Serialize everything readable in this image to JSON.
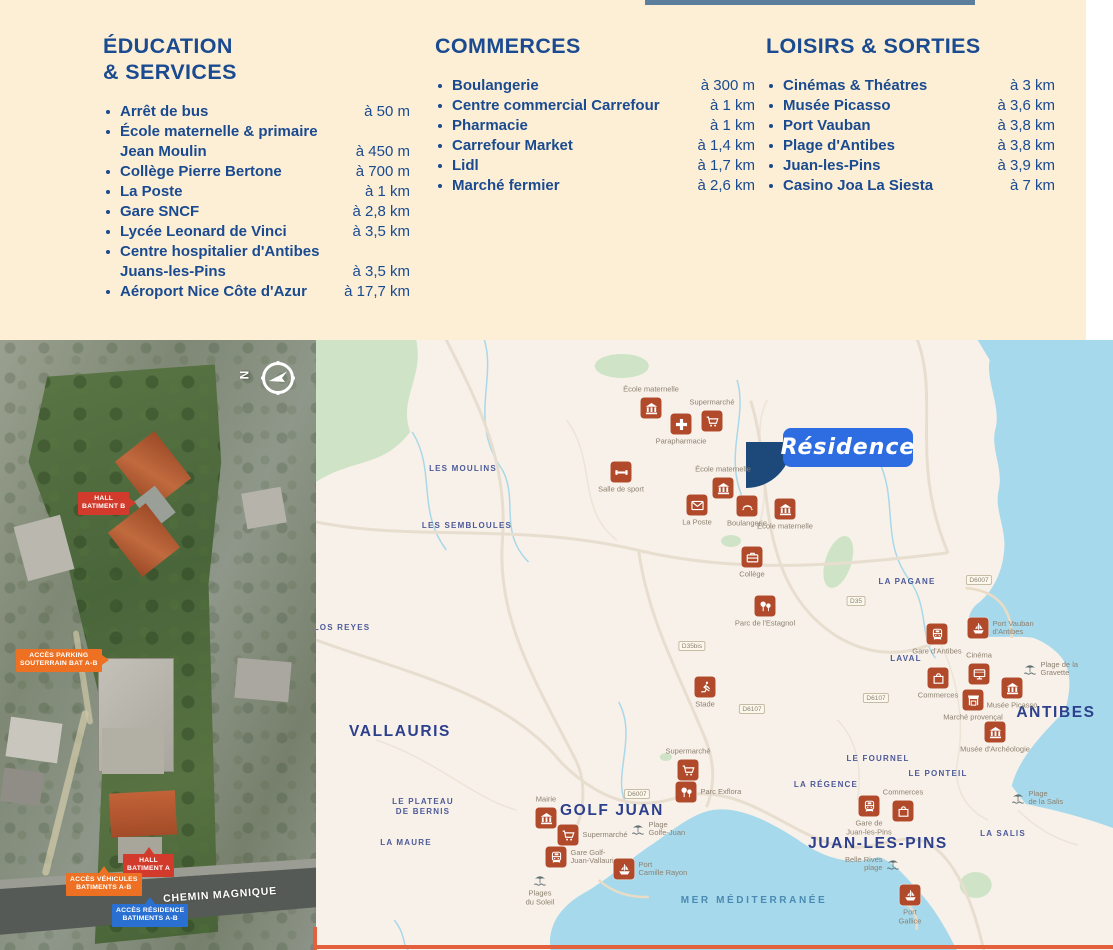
{
  "colors": {
    "navy": "#1a4a90",
    "cream": "#fcefd6",
    "rust": "#b04a2a",
    "map_bg": "#f8f1e9",
    "water": "#a6d9ec",
    "green": "#cfe4c6",
    "orange": "#ee7123",
    "red": "#d23b2b",
    "access_blue": "#2a6fd2",
    "residence_blue": "#2e6ce2",
    "marker_navy": "#1c4979",
    "bottom_line": "#e2603c",
    "top_bar": "#5b7e9c"
  },
  "panel": {
    "columns": [
      {
        "title_lines": [
          "ÉDUCATION",
          "& SERVICES"
        ],
        "items": [
          {
            "lines": [
              "Arrêt de bus"
            ],
            "distance": "à 50 m"
          },
          {
            "lines": [
              "École maternelle & primaire",
              "Jean Moulin"
            ],
            "distance": "à 450 m"
          },
          {
            "lines": [
              "Collège Pierre Bertone"
            ],
            "distance": "à 700 m"
          },
          {
            "lines": [
              "La Poste"
            ],
            "distance": "à 1 km"
          },
          {
            "lines": [
              "Gare SNCF"
            ],
            "distance": "à 2,8 km"
          },
          {
            "lines": [
              "Lycée Leonard de Vinci"
            ],
            "distance": "à 3,5 km"
          },
          {
            "lines": [
              "Centre hospitalier d'Antibes",
              "Juans-les-Pins"
            ],
            "distance": "à 3,5 km"
          },
          {
            "lines": [
              "Aéroport Nice Côte d'Azur"
            ],
            "distance": "à 17,7 km"
          }
        ]
      },
      {
        "title_lines": [
          "COMMERCES"
        ],
        "items": [
          {
            "lines": [
              "Boulangerie"
            ],
            "distance": "à 300 m"
          },
          {
            "lines": [
              "Centre commercial Carrefour"
            ],
            "distance": "à 1 km"
          },
          {
            "lines": [
              "Pharmacie"
            ],
            "distance": "à 1 km"
          },
          {
            "lines": [
              "Carrefour Market"
            ],
            "distance": "à 1,4 km"
          },
          {
            "lines": [
              "Lidl"
            ],
            "distance": "à 1,7 km"
          },
          {
            "lines": [
              "Marché fermier"
            ],
            "distance": "à 2,6 km"
          }
        ]
      },
      {
        "title_lines": [
          "LOISIRS & SORTIES"
        ],
        "items": [
          {
            "lines": [
              "Cinémas & Théatres"
            ],
            "distance": "à 3 km"
          },
          {
            "lines": [
              "Musée Picasso"
            ],
            "distance": "à 3,6 km"
          },
          {
            "lines": [
              "Port Vauban"
            ],
            "distance": "à 3,8 km"
          },
          {
            "lines": [
              "Plage d'Antibes"
            ],
            "distance": "à 3,8 km"
          },
          {
            "lines": [
              "Juan-les-Pins"
            ],
            "distance": "à 3,9 km"
          },
          {
            "lines": [
              "Casino Joa La Siesta"
            ],
            "distance": "à 7 km"
          }
        ]
      }
    ]
  },
  "aerial": {
    "compass_letter": "N",
    "road_label": "CHEMIN MAGNIQUE",
    "labels": [
      {
        "lines": [
          "HALL",
          "BATIMENT B"
        ],
        "type": "red",
        "x": 78,
        "y": 152,
        "arrow": "right"
      },
      {
        "lines": [
          "ACCÈS PARKING",
          "SOUTERRAIN BAT A-B"
        ],
        "type": "orange",
        "x": 16,
        "y": 309,
        "arrow": "right"
      },
      {
        "lines": [
          "HALL",
          "BATIMENT A"
        ],
        "type": "red",
        "x": 123,
        "y": 514,
        "arrow": "up"
      },
      {
        "lines": [
          "ACCÈS VÉHICULES",
          "BATIMENTS A-B"
        ],
        "type": "orange",
        "x": 66,
        "y": 533,
        "arrow": "up"
      },
      {
        "lines": [
          "ACCÈS RÉSIDENCE",
          "BATIMENTS A-B"
        ],
        "type": "blue",
        "x": 112,
        "y": 564,
        "arrow": "up"
      }
    ]
  },
  "map": {
    "residence": {
      "label": "Résidence"
    },
    "pois": [
      {
        "icon": "building",
        "x": 335,
        "y": 68,
        "label": [
          "École maternelle"
        ],
        "lpos": "above"
      },
      {
        "icon": "cart",
        "x": 396,
        "y": 81,
        "label": [
          "Supermarché"
        ],
        "lpos": "above"
      },
      {
        "icon": "cross",
        "x": 365,
        "y": 84,
        "label": [
          "Parapharmacie"
        ],
        "lpos": "below"
      },
      {
        "icon": "dumbbell",
        "x": 305,
        "y": 132,
        "label": [
          "Salle de sport"
        ],
        "lpos": "below"
      },
      {
        "icon": "building",
        "x": 407,
        "y": 148,
        "label": [
          "École maternelle"
        ],
        "lpos": "above"
      },
      {
        "icon": "envelope",
        "x": 381,
        "y": 165,
        "label": [
          "La Poste"
        ],
        "lpos": "below"
      },
      {
        "icon": "croissant",
        "x": 431,
        "y": 166,
        "label": [
          "Boulangerie"
        ],
        "lpos": "below"
      },
      {
        "icon": "building",
        "x": 469,
        "y": 169,
        "label": [
          "École maternelle"
        ],
        "lpos": "below"
      },
      {
        "icon": "case",
        "x": 436,
        "y": 217,
        "label": [
          "Collège"
        ],
        "lpos": "below"
      },
      {
        "icon": "trees",
        "x": 449,
        "y": 266,
        "label": [
          "Parc de l'Estagnol"
        ],
        "lpos": "below"
      },
      {
        "icon": "runner",
        "x": 389,
        "y": 347,
        "label": [
          "Stade"
        ],
        "lpos": "below"
      },
      {
        "icon": "train",
        "x": 621,
        "y": 294,
        "label": [
          "Gare d'Antibes"
        ],
        "lpos": "below"
      },
      {
        "icon": "boat",
        "x": 662,
        "y": 288,
        "label": [
          "Port Vauban",
          "d'Antibes"
        ],
        "lpos": "right"
      },
      {
        "icon": "screen",
        "x": 663,
        "y": 334,
        "label": [
          "Cinéma"
        ],
        "lpos": "above"
      },
      {
        "icon": "bag",
        "x": 622,
        "y": 338,
        "label": [
          "Commerces"
        ],
        "lpos": "below"
      },
      {
        "icon": "building",
        "x": 696,
        "y": 348,
        "label": [
          "Musée Picasso"
        ],
        "lpos": "below"
      },
      {
        "icon": "stall",
        "x": 657,
        "y": 360,
        "label": [
          "Marché provençal"
        ],
        "lpos": "below"
      },
      {
        "icon": "building",
        "x": 679,
        "y": 392,
        "label": [
          "Musée d'Archéologie"
        ],
        "lpos": "below"
      },
      {
        "icon": "cart",
        "x": 372,
        "y": 430,
        "label": [
          "Supermarché"
        ],
        "lpos": "above"
      },
      {
        "icon": "trees",
        "x": 370,
        "y": 452,
        "label": [
          "Parc Exflora"
        ],
        "lpos": "right"
      },
      {
        "icon": "building",
        "x": 230,
        "y": 478,
        "label": [
          "Mairie"
        ],
        "lpos": "above"
      },
      {
        "icon": "cart",
        "x": 252,
        "y": 495,
        "label": [
          "Supermarché"
        ],
        "lpos": "right"
      },
      {
        "icon": "train",
        "x": 240,
        "y": 517,
        "label": [
          "Gare Golf-",
          "Juan-Vallauris"
        ],
        "lpos": "right"
      },
      {
        "icon": "boat",
        "x": 308,
        "y": 529,
        "label": [
          "Port",
          "Camille Rayon"
        ],
        "lpos": "right"
      },
      {
        "icon": "train",
        "x": 553,
        "y": 466,
        "label": [
          "Gare de",
          "Juan-les-Pins"
        ],
        "lpos": "below"
      },
      {
        "icon": "bag",
        "x": 587,
        "y": 471,
        "label": [
          "Commerces"
        ],
        "lpos": "above"
      },
      {
        "icon": "boat",
        "x": 594,
        "y": 555,
        "label": [
          "Port",
          "Gallice"
        ],
        "lpos": "below"
      }
    ],
    "beaches": [
      {
        "x": 714,
        "y": 329,
        "label": [
          "Plage de la",
          "Gravette"
        ],
        "lpos": "right"
      },
      {
        "x": 322,
        "y": 489,
        "label": [
          "Plage",
          "Golfe-Juan"
        ],
        "lpos": "right"
      },
      {
        "x": 224,
        "y": 540,
        "label": [
          "Plages",
          "du Soleil"
        ],
        "lpos": "below"
      },
      {
        "x": 577,
        "y": 524,
        "label": [
          "Belle Rives",
          "plage"
        ],
        "lpos": "left"
      },
      {
        "x": 702,
        "y": 458,
        "label": [
          "Plage",
          "de la Salis"
        ],
        "lpos": "right"
      }
    ],
    "places": [
      {
        "lines": [
          "LES MOULINS"
        ],
        "x": 147,
        "y": 129,
        "size": "small"
      },
      {
        "lines": [
          "LES SEMBLOULES"
        ],
        "x": 151,
        "y": 186,
        "size": "small"
      },
      {
        "lines": [
          "LOS REYES"
        ],
        "x": 26,
        "y": 288,
        "size": "small"
      },
      {
        "lines": [
          "VALLAURIS"
        ],
        "x": 84,
        "y": 392,
        "size": "big"
      },
      {
        "lines": [
          "LE PLATEAU",
          "DE BERNIS"
        ],
        "x": 107,
        "y": 467,
        "size": "small"
      },
      {
        "lines": [
          "LA MAURE"
        ],
        "x": 90,
        "y": 503,
        "size": "small"
      },
      {
        "lines": [
          "GOLF JUAN"
        ],
        "x": 296,
        "y": 471,
        "size": "big"
      },
      {
        "lines": [
          "LA PAGANE"
        ],
        "x": 591,
        "y": 242,
        "size": "small"
      },
      {
        "lines": [
          "LAVAL"
        ],
        "x": 590,
        "y": 319,
        "size": "small"
      },
      {
        "lines": [
          "LE FOURNEL"
        ],
        "x": 562,
        "y": 419,
        "size": "small"
      },
      {
        "lines": [
          "LA RÉGENCE"
        ],
        "x": 510,
        "y": 445,
        "size": "small"
      },
      {
        "lines": [
          "LE PONTEIL"
        ],
        "x": 622,
        "y": 434,
        "size": "small"
      },
      {
        "lines": [
          "LA SALIS"
        ],
        "x": 687,
        "y": 494,
        "size": "small"
      },
      {
        "lines": [
          "JUAN-LES-PINS"
        ],
        "x": 562,
        "y": 504,
        "size": "big"
      },
      {
        "lines": [
          "ANTIBES"
        ],
        "x": 740,
        "y": 373,
        "size": "big"
      },
      {
        "lines": [
          "MER MÉDITERRANÉE"
        ],
        "x": 438,
        "y": 561,
        "size": "sea"
      }
    ],
    "badges": [
      {
        "text": "D6007",
        "x": 663,
        "y": 240
      },
      {
        "text": "D35",
        "x": 540,
        "y": 261
      },
      {
        "text": "D35bis",
        "x": 376,
        "y": 306
      },
      {
        "text": "D6107",
        "x": 560,
        "y": 358
      },
      {
        "text": "D6107",
        "x": 436,
        "y": 369
      },
      {
        "text": "D6007",
        "x": 321,
        "y": 454
      }
    ]
  }
}
